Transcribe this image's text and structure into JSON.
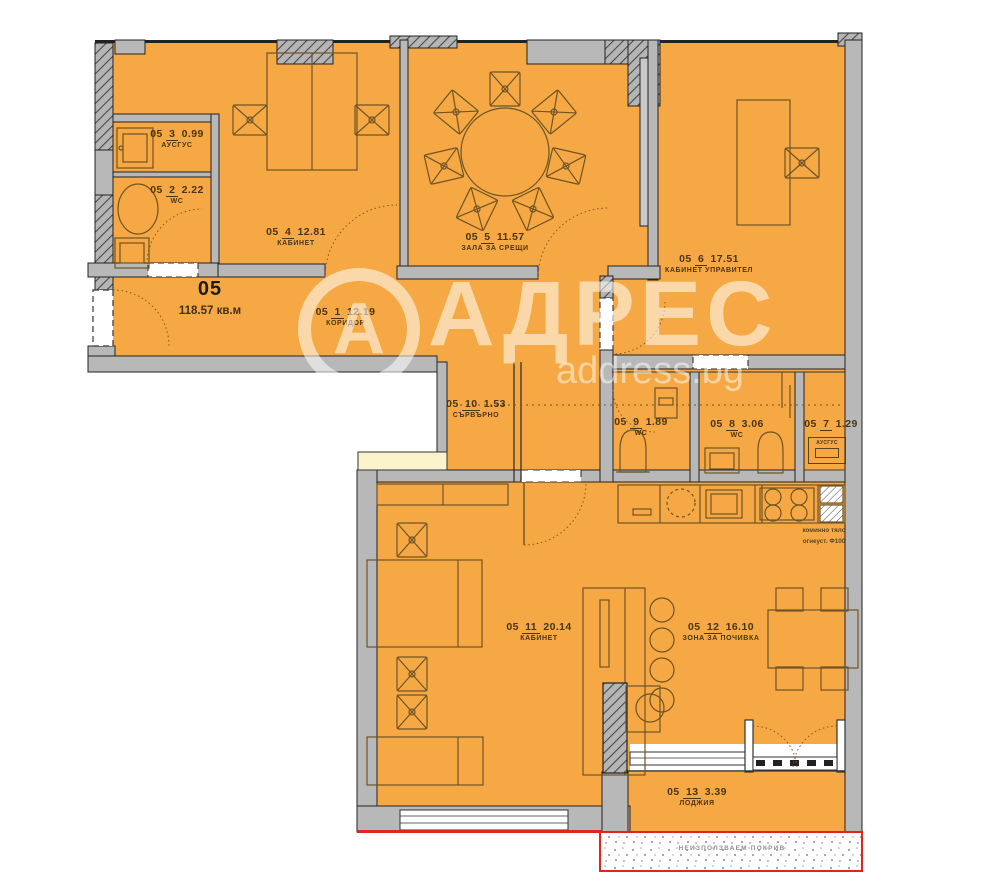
{
  "meta": {
    "brand": "АДРЕС",
    "brand_domain": "address.bg",
    "logo_letter": "А"
  },
  "unit": {
    "number": "05",
    "area": "118.57 кв.м"
  },
  "rooms": [
    {
      "unit": "05",
      "index": "1",
      "area": "12.19",
      "name": "КОРИДОР"
    },
    {
      "unit": "05",
      "index": "2",
      "area": "2.22",
      "name": "WC"
    },
    {
      "unit": "05",
      "index": "3",
      "area": "0.99",
      "name": "АУСГУС"
    },
    {
      "unit": "05",
      "index": "4",
      "area": "12.81",
      "name": "КАБИНЕТ"
    },
    {
      "unit": "05",
      "index": "5",
      "area": "11.57",
      "name": "ЗАЛА ЗА СРЕЩИ"
    },
    {
      "unit": "05",
      "index": "6",
      "area": "17.51",
      "name": "КАБИНЕТ УПРАВИТЕЛ"
    },
    {
      "unit": "05",
      "index": "7",
      "area": "1.29",
      "name": "АУСГУС"
    },
    {
      "unit": "05",
      "index": "8",
      "area": "3.06",
      "name": "WC"
    },
    {
      "unit": "05",
      "index": "9",
      "area": "1.89",
      "name": "WC"
    },
    {
      "unit": "05",
      "index": "10",
      "area": "1.53",
      "name": "СЪРВЪРНО"
    },
    {
      "unit": "05",
      "index": "11",
      "area": "20.14",
      "name": "КАБИНЕТ"
    },
    {
      "unit": "05",
      "index": "12",
      "area": "16.10",
      "name": "ЗОНА ЗА ПОЧИВКА"
    },
    {
      "unit": "05",
      "index": "13",
      "area": "3.39",
      "name": "ЛОДЖИЯ"
    }
  ],
  "annotations": {
    "chimney_line1": "коминно тяло",
    "chimney_line2": "огнеуст. Ф100",
    "roof": "НЕИЗПОЛЗВАЕМ ПОКРИВ"
  },
  "colors": {
    "room_fill": "#F5A843",
    "wall_gray": "#B8B8B8",
    "line_dark": "#222222",
    "furniture_line": "#6E5426",
    "roof_border_red": "#E3241C",
    "window_strip_yellow": "#FBF3CC",
    "watermark_white": "rgba(255,255,255,0.55)"
  }
}
